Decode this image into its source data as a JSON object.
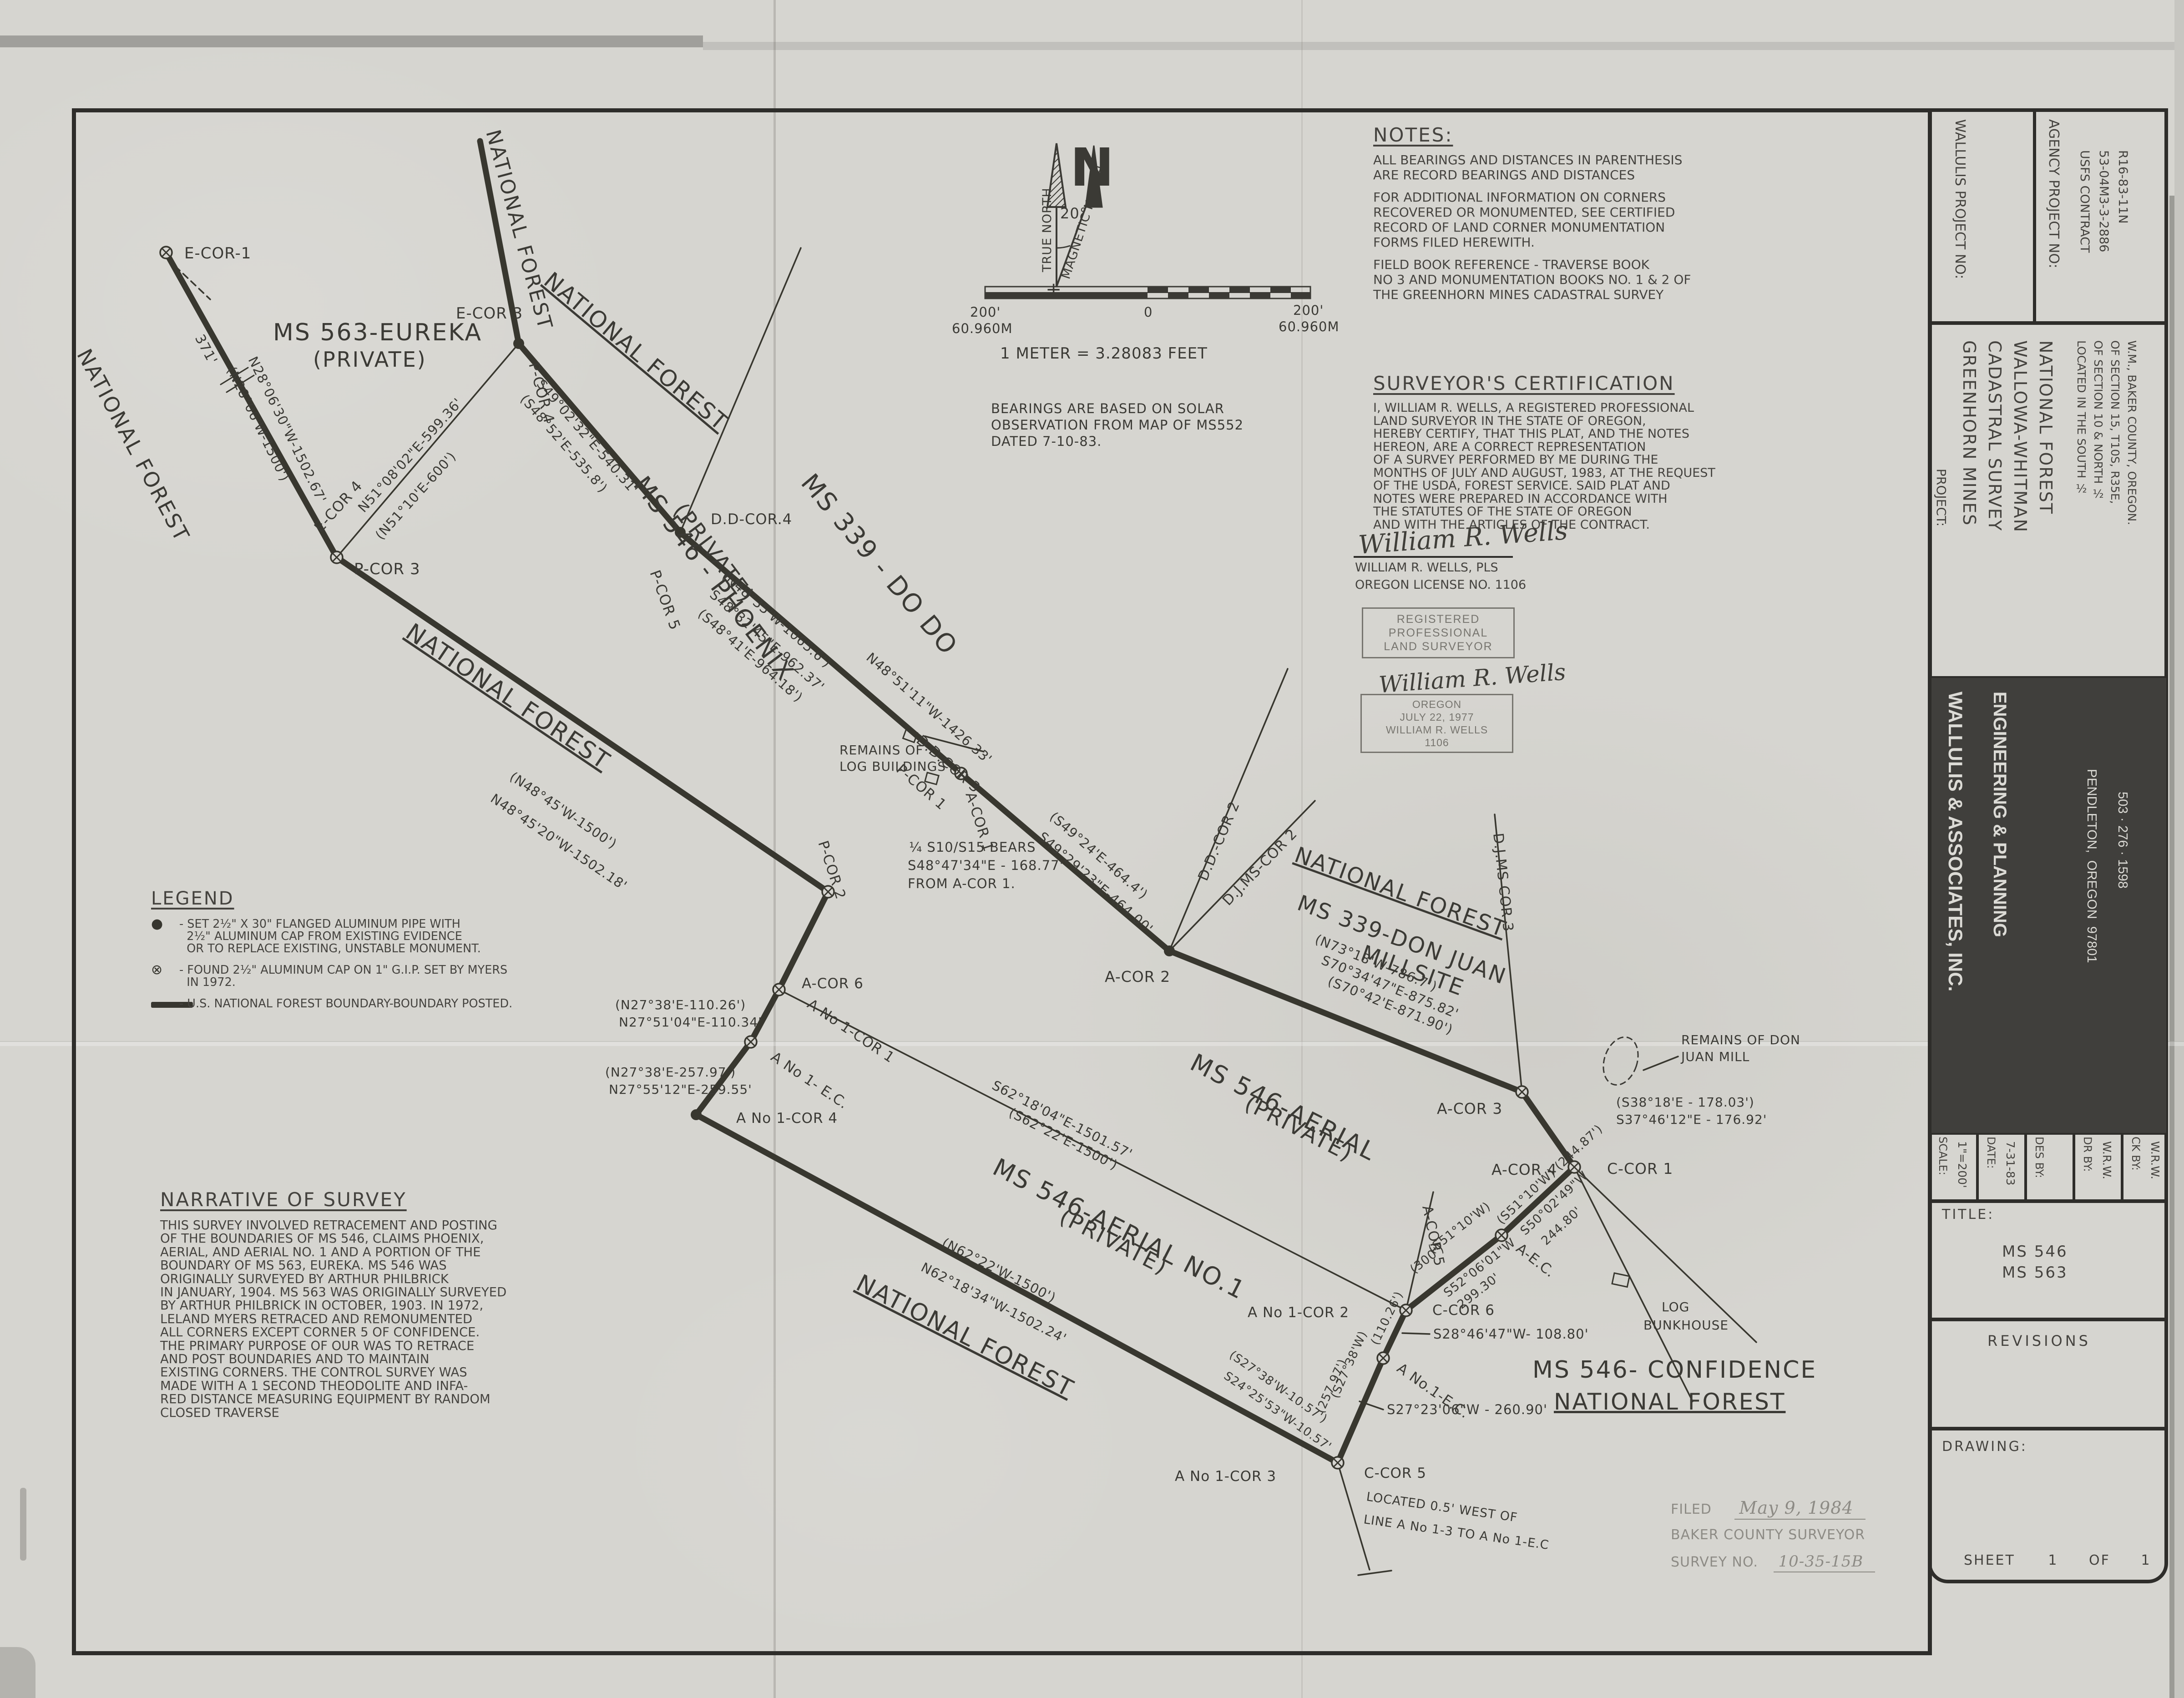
{
  "notes": {
    "title": "NOTES:",
    "p1": [
      "ALL BEARINGS AND DISTANCES IN PARENTHESIS",
      "ARE RECORD BEARINGS AND DISTANCES"
    ],
    "p2": [
      "FOR ADDITIONAL INFORMATION ON CORNERS",
      "RECOVERED OR MONUMENTED, SEE CERTIFIED",
      "RECORD OF LAND CORNER MONUMENTATION",
      "FORMS FILED HEREWITH."
    ],
    "p3": [
      "FIELD BOOK REFERENCE - TRAVERSE BOOK",
      "NO 3 AND MONUMENTATION BOOKS NO. 1 & 2 OF",
      "THE GREENHORN MINES CADASTRAL SURVEY"
    ]
  },
  "certification": {
    "title": "SURVEYOR'S CERTIFICATION",
    "body": [
      "I, WILLIAM R. WELLS, A REGISTERED PROFESSIONAL",
      "LAND SURVEYOR IN THE STATE OF OREGON,",
      "HEREBY CERTIFY, THAT THIS PLAT, AND THE NOTES",
      "HEREON, ARE A CORRECT REPRESENTATION",
      "OF A SURVEY PERFORMED BY ME DURING THE",
      "MONTHS OF JULY AND AUGUST, 1983, AT THE REQUEST",
      "OF THE USDA, FOREST SERVICE. SAID PLAT AND",
      "NOTES WERE PREPARED IN ACCORDANCE WITH",
      "THE STATUTES OF THE STATE OF OREGON",
      "AND WITH THE ARTICLES OF THE CONTRACT."
    ],
    "signature": "William R. Wells",
    "name": "WILLIAM R. WELLS, PLS",
    "license": "OREGON LICENSE  NO. 1106",
    "stamp_registered": [
      "REGISTERED",
      "PROFESSIONAL",
      "LAND SURVEYOR"
    ],
    "signature2": "William R. Wells",
    "stamp_oregon": [
      "OREGON",
      "JULY 22, 1977",
      "WILLIAM R. WELLS",
      "1106"
    ]
  },
  "legend": {
    "title": "LEGEND",
    "item1": [
      "- SET 2½\" X 30\" FLANGED ALUMINUM PIPE WITH",
      "  2½\" ALUMINUM CAP FROM EXISTING EVIDENCE",
      "  OR TO REPLACE EXISTING, UNSTABLE MONUMENT."
    ],
    "item2": [
      "- FOUND 2½\" ALUMINUM CAP ON 1\" G.I.P. SET BY MYERS",
      "  IN 1972."
    ],
    "item3": [
      "- U.S. NATIONAL FOREST BOUNDARY-BOUNDARY POSTED."
    ]
  },
  "narrative": {
    "title": "NARRATIVE OF SURVEY",
    "body": [
      "THIS SURVEY INVOLVED RETRACEMENT AND POSTING",
      "OF THE BOUNDARIES OF MS 546, CLAIMS PHOENIX,",
      "AERIAL, AND AERIAL NO. 1 AND A PORTION OF THE",
      "BOUNDARY OF MS 563, EUREKA. MS 546 WAS",
      "ORIGINALLY SURVEYED BY ARTHUR PHILBRICK",
      "IN JANUARY, 1904. MS 563 WAS ORIGINALLY SURVEYED",
      "BY ARTHUR PHILBRICK IN OCTOBER, 1903. IN 1972,",
      "LELAND MYERS RETRACED AND REMONUMENTED",
      "ALL CORNERS EXCEPT CORNER 5 OF CONFIDENCE.",
      "THE PRIMARY PURPOSE OF OUR WAS TO RETRACE",
      "AND POST BOUNDARIES AND TO MAINTAIN",
      "EXISTING CORNERS. THE CONTROL SURVEY WAS",
      "MADE WITH A 1 SECOND THEODOLITE AND INFA-",
      "RED DISTANCE MEASURING EQUIPMENT BY RANDOM",
      "CLOSED TRAVERSE"
    ]
  },
  "filed": {
    "label": "FILED",
    "date": "May 9, 1984",
    "line2": "BAKER COUNTY SURVEYOR",
    "no_label": "SURVEY NO.",
    "no_value": "10-35-15B"
  },
  "titleblock": {
    "wallulis_label": "WALLULIS PROJECT NO:",
    "agency_label": "AGENCY PROJECT NO:",
    "agency_value": [
      "USFS CONTRACT",
      "53-04M3-3-2886",
      "R16-83-11N"
    ],
    "project_label": "PROJECT:",
    "project_name": [
      "GREENHORN MINES",
      "CADASTRAL SURVEY",
      "WALLOWA-WHITMAN",
      "NATIONAL FOREST"
    ],
    "project_location": [
      "LOCATED IN THE SOUTH ½",
      "OF SECTION 10 & NORTH ½",
      "OF SECTION 15, T10S, R35E,",
      "W.M., BAKER COUNTY, OREGON."
    ],
    "firm_name": "WALLULIS & ASSOCIATES, INC.",
    "firm_dept": "ENGINEERING & PLANNING",
    "firm_city": "PENDLETON,  OREGON  97801",
    "firm_phone": "503 · 276 · 1598",
    "scale_label": "SCALE:",
    "scale_value": "1\"=200'",
    "date_label": "DATE:",
    "date_value": "7-31-83",
    "desby_label": "DES BY:",
    "desby_value": "",
    "drby_label": "DR BY:",
    "drby_value": "W.R.W.",
    "ckby_label": "CK BY:",
    "ckby_value": "W.R.W.",
    "title_label": "TITLE:",
    "title_value": [
      "MS 546",
      "MS 563"
    ],
    "revisions_label": "REVISIONS",
    "drawing_label": "DRAWING:",
    "sheet_word": "SHEET",
    "sheet_no": "1",
    "of_word": "OF",
    "of_no": "1"
  },
  "map": {
    "thick": [
      [
        365,
        555,
        740,
        1225
      ],
      [
        740,
        1225,
        1820,
        1960
      ],
      [
        1820,
        1960,
        1712,
        2175
      ],
      [
        1712,
        2175,
        1650,
        2290
      ],
      [
        1650,
        2290,
        1530,
        2450
      ],
      [
        1530,
        2450,
        2940,
        3215
      ],
      [
        3040,
        2985,
        2940,
        3215
      ],
      [
        3090,
        2880,
        3040,
        2985
      ],
      [
        3300,
        2715,
        3090,
        2880
      ],
      [
        3460,
        2565,
        3300,
        2715
      ],
      [
        3345,
        2400,
        3460,
        2565
      ],
      [
        2570,
        2090,
        3345,
        2400
      ],
      [
        2112,
        1700,
        2570,
        2090
      ],
      [
        1495,
        1170,
        2112,
        1700
      ],
      [
        1140,
        755,
        1495,
        1170
      ],
      [
        1055,
        310,
        1140,
        755
      ]
    ],
    "thin": [
      [
        740,
        1225,
        1140,
        755
      ],
      [
        1495,
        1170,
        1760,
        545
      ],
      [
        2570,
        2090,
        2830,
        1470
      ],
      [
        2570,
        2090,
        2890,
        1760
      ],
      [
        3345,
        2400,
        3285,
        1790
      ],
      [
        3460,
        2565,
        3860,
        2950
      ],
      [
        3460,
        2565,
        3720,
        3080
      ],
      [
        2940,
        3215,
        3010,
        3450
      ],
      [
        2985,
        3462,
        3058,
        3452
      ],
      [
        3090,
        2880,
        3150,
        2620
      ],
      [
        1712,
        2175,
        3090,
        2880
      ],
      [
        2162,
        1652,
        2032,
        1618
      ],
      [
        3688,
        2322,
        3612,
        2352
      ],
      [
        3142,
        2932,
        3082,
        2930
      ],
      [
        3040,
        3098,
        2988,
        3080
      ]
    ],
    "dashed": [
      [
        385,
        585,
        462,
        658
      ],
      [
        2112,
        1700,
        2200,
        1772
      ]
    ],
    "ticks": [
      [
        485,
        845,
        545,
        808
      ],
      [
        498,
        862,
        558,
        825
      ]
    ],
    "circled": [
      [
        365,
        555
      ],
      [
        740,
        1225
      ],
      [
        2112,
        1700
      ],
      [
        3345,
        2400
      ],
      [
        3460,
        2565
      ],
      [
        3300,
        2715
      ],
      [
        3090,
        2880
      ],
      [
        3040,
        2985
      ],
      [
        2940,
        3215
      ],
      [
        1650,
        2290
      ],
      [
        1712,
        2175
      ],
      [
        1820,
        1960
      ]
    ],
    "dots": [
      [
        1140,
        755
      ],
      [
        1495,
        1170
      ],
      [
        2570,
        2090
      ],
      [
        1530,
        2450
      ]
    ],
    "buildings": [
      [
        1992,
        1602,
        26,
        22,
        20
      ],
      [
        2038,
        1698,
        26,
        20,
        15
      ],
      [
        3548,
        2798,
        34,
        24,
        12
      ]
    ],
    "labels": [
      [
        "E-COR-1",
        405,
        568,
        0,
        34,
        ""
      ],
      [
        "371'",
        428,
        742,
        62,
        30,
        ""
      ],
      [
        "MS 563-EUREKA",
        600,
        748,
        0,
        52,
        ""
      ],
      [
        "(PRIVATE)",
        688,
        806,
        0,
        46,
        ""
      ],
      [
        "NATIONAL FOREST",
        1068,
        290,
        75,
        44,
        ""
      ],
      [
        "NATIONAL FOREST",
        168,
        778,
        62,
        46,
        ""
      ],
      [
        "NATIONAL FOREST",
        888,
        1398,
        34,
        52,
        "u"
      ],
      [
        "NATIONAL FOREST",
        1192,
        622,
        40,
        50,
        "u"
      ],
      [
        "MS 339 - DO DO",
        1758,
        1062,
        50,
        56,
        ""
      ],
      [
        "NATIONAL FOREST",
        2842,
        1892,
        20,
        48,
        "u"
      ],
      [
        "MS 339-DON JUAN",
        2848,
        1998,
        20,
        48,
        ""
      ],
      [
        "MILLSITE",
        2988,
        2108,
        20,
        48,
        ""
      ],
      [
        "NATIONAL FOREST",
        1878,
        2832,
        27,
        52,
        "u"
      ],
      [
        "MS 546- CONFIDENCE",
        3368,
        3028,
        0,
        52,
        ""
      ],
      [
        "NATIONAL FOREST",
        3415,
        3098,
        0,
        50,
        "u"
      ],
      [
        "MS 546 - PHOENIX",
        1390,
        1065,
        53,
        54,
        ""
      ],
      [
        "(PRIVATE)",
        1478,
        1122,
        53,
        48,
        ""
      ],
      [
        "MS 546-AERIAL",
        2612,
        2348,
        27,
        54,
        ""
      ],
      [
        "(PRIVATE)",
        2732,
        2436,
        27,
        48,
        ""
      ],
      [
        "MS 546-AERIAL NO.1",
        2178,
        2578,
        27,
        54,
        ""
      ],
      [
        "(PRIVATE)",
        2325,
        2685,
        27,
        48,
        ""
      ],
      [
        "(N28°06'W-1500')",
        498,
        812,
        64,
        29,
        ""
      ],
      [
        "N28°06'30\"W-1502.67'",
        545,
        790,
        64,
        29,
        ""
      ],
      [
        "E-COR 4",
        705,
        1172,
        -48,
        32,
        ""
      ],
      [
        "N51°08'02\"E-599.36'",
        800,
        1128,
        -48,
        29,
        ""
      ],
      [
        "(N51°10'E-600')",
        838,
        1188,
        -48,
        29,
        ""
      ],
      [
        "E-COR 3",
        1002,
        700,
        0,
        34,
        ""
      ],
      [
        "P-COR 4",
        1162,
        800,
        75,
        32,
        ""
      ],
      [
        "P-COR 3",
        778,
        1262,
        0,
        34,
        ""
      ],
      [
        "S49°02'32\"E-540.31'",
        1178,
        845,
        49,
        29,
        ""
      ],
      [
        "(S48°52'E-535.8')",
        1142,
        878,
        49,
        29,
        ""
      ],
      [
        "P-COR 5",
        1428,
        1258,
        70,
        32,
        ""
      ],
      [
        "D.D-COR.4",
        1562,
        1152,
        0,
        32,
        ""
      ],
      [
        "(N48°35'W-1065.6')",
        1585,
        1268,
        41,
        29,
        ""
      ],
      [
        "S48°32'45\"E-962.37'",
        1558,
        1310,
        41,
        29,
        ""
      ],
      [
        "(S48°41'E-964.18')",
        1532,
        1352,
        41,
        29,
        ""
      ],
      [
        "N48°51'11\"W-1426.33'",
        1902,
        1448,
        41,
        29,
        ""
      ],
      [
        "REMAINS OF",
        1845,
        1658,
        0,
        28,
        ""
      ],
      [
        "LOG BUILDINGS",
        1845,
        1694,
        0,
        28,
        ""
      ],
      [
        "D.D.COR 3",
        2012,
        1630,
        41,
        31,
        ""
      ],
      [
        "P-COR 1",
        1968,
        1694,
        41,
        31,
        ""
      ],
      [
        "A-COR 1",
        2122,
        1745,
        72,
        31,
        ""
      ],
      [
        "(S49°24'E-464.4')",
        2305,
        1798,
        41,
        29,
        ""
      ],
      [
        "S49°29'23\"E-464.00'",
        2280,
        1842,
        41,
        29,
        ""
      ],
      [
        "¼ S10/S15 BEARS",
        1998,
        1872,
        0,
        29,
        ""
      ],
      [
        "S48°47'34\"E - 168.77'",
        1995,
        1912,
        0,
        29,
        ""
      ],
      [
        "FROM A-COR 1.",
        1995,
        1952,
        0,
        29,
        ""
      ],
      [
        "A-COR 2",
        2428,
        2158,
        0,
        33,
        ""
      ],
      [
        "D.D.-COR 2",
        2652,
        1938,
        -67,
        31,
        ""
      ],
      [
        "D.J.MS-COR 2",
        2700,
        1992,
        -46,
        31,
        ""
      ],
      [
        "(N73°18'W-786.7')",
        2888,
        2072,
        22,
        29,
        ""
      ],
      [
        "S70°34'47\"E-875.82'",
        2902,
        2118,
        22,
        29,
        ""
      ],
      [
        "(S70°42'E-871.90')",
        2916,
        2164,
        22,
        29,
        ""
      ],
      [
        "D.J.MS COR 3",
        3282,
        1832,
        84,
        31,
        ""
      ],
      [
        "A-COR 3",
        3158,
        2448,
        0,
        33,
        ""
      ],
      [
        "REMAINS OF DON",
        3695,
        2295,
        0,
        28,
        ""
      ],
      [
        "JUAN MILL",
        3695,
        2332,
        0,
        28,
        ""
      ],
      [
        "(S38°18'E - 178.03')",
        3552,
        2432,
        0,
        28,
        ""
      ],
      [
        "S37°46'12\"E - 176.92'",
        3552,
        2470,
        0,
        28,
        ""
      ],
      [
        "A-COR 4",
        3278,
        2582,
        0,
        33,
        ""
      ],
      [
        "C-COR 1",
        3532,
        2580,
        0,
        33,
        ""
      ],
      [
        "(S51°10'W) (244.87')",
        3300,
        2692,
        -43,
        27,
        ""
      ],
      [
        "S50°02'49\"W",
        3352,
        2716,
        -43,
        27,
        ""
      ],
      [
        "244.80'",
        3398,
        2738,
        -43,
        27,
        ""
      ],
      [
        "A-E.C.",
        3330,
        2748,
        38,
        31,
        ""
      ],
      [
        "LOG",
        3652,
        2882,
        0,
        28,
        ""
      ],
      [
        "BUNKHOUSE",
        3612,
        2922,
        0,
        28,
        ""
      ],
      [
        "(S51°10'W)",
        3148,
        2756,
        -38,
        27,
        ""
      ],
      [
        "(300')",
        3108,
        2800,
        -38,
        27,
        ""
      ],
      [
        "S52°06'01\"W",
        3182,
        2852,
        -38,
        27,
        ""
      ],
      [
        "299.30'",
        3212,
        2878,
        -38,
        27,
        ""
      ],
      [
        "A-COR 5",
        3126,
        2652,
        78,
        31,
        ""
      ],
      [
        "A No 1-COR 2",
        2742,
        2895,
        0,
        31,
        ""
      ],
      [
        "C-COR 6",
        3148,
        2890,
        0,
        31,
        ""
      ],
      [
        "(110.26')",
        3028,
        2958,
        -64,
        26,
        ""
      ],
      [
        "S28°46'47\"W- 108.80'",
        3150,
        2942,
        0,
        29,
        ""
      ],
      [
        "A No.1-E.C.",
        3068,
        3012,
        35,
        31,
        ""
      ],
      [
        "(S27°38'W)",
        2940,
        3075,
        -66,
        26,
        ""
      ],
      [
        "(257.97')",
        2908,
        3108,
        -66,
        26,
        ""
      ],
      [
        "S27°23'06\"W - 260.90'",
        3048,
        3108,
        0,
        29,
        ""
      ],
      [
        "(S27°38'W-10.57')",
        2700,
        2982,
        35,
        26,
        ""
      ],
      [
        "S24°25'53\"W-10.57'",
        2688,
        3028,
        35,
        26,
        ""
      ],
      [
        "A No 1-COR 3",
        2582,
        3255,
        0,
        31,
        ""
      ],
      [
        "C-COR 5",
        2998,
        3248,
        0,
        31,
        ""
      ],
      [
        "LOCATED 0.5' WEST OF",
        3002,
        3298,
        8,
        27,
        ""
      ],
      [
        "LINE A No 1-3 TO A No 1-E.C",
        2996,
        3348,
        8,
        27,
        ""
      ],
      [
        "S62°18'04\"E-1501.57'",
        2178,
        2392,
        27,
        29,
        ""
      ],
      [
        "(S62°22'E-1500')",
        2215,
        2452,
        27,
        29,
        ""
      ],
      [
        "(N62°22'W-1500')",
        2068,
        2738,
        27,
        29,
        ""
      ],
      [
        "N62°18'34\"W-1502.24'",
        2022,
        2792,
        27,
        29,
        ""
      ],
      [
        "P-COR 2",
        1798,
        1852,
        72,
        31,
        ""
      ],
      [
        "A-COR 6",
        1762,
        2172,
        0,
        31,
        ""
      ],
      [
        "A No 1-COR 1",
        1772,
        2212,
        34,
        31,
        ""
      ],
      [
        "A No 1- E.C.",
        1692,
        2328,
        34,
        31,
        ""
      ],
      [
        "A No 1-COR 4",
        1618,
        2468,
        0,
        31,
        ""
      ],
      [
        "(N27°38'E-110.26')",
        1352,
        2218,
        0,
        28,
        ""
      ],
      [
        "N27°51'04\"E-110.34'",
        1360,
        2256,
        0,
        28,
        ""
      ],
      [
        "(N27°38'E-257.97')",
        1330,
        2366,
        0,
        28,
        ""
      ],
      [
        "N27°55'12\"E-259.55'",
        1338,
        2404,
        0,
        28,
        ""
      ],
      [
        "(N48°45'W-1500')",
        1118,
        1712,
        34,
        29,
        ""
      ],
      [
        "N48°45'20\"W-1502.18'",
        1076,
        1760,
        34,
        29,
        ""
      ],
      [
        "N",
        2352,
        408,
        0,
        115,
        "b"
      ],
      [
        "TRUE NORTH",
        2310,
        598,
        -90,
        27,
        ""
      ],
      [
        "MAGNETIC NORTH",
        2350,
        615,
        -72,
        27,
        ""
      ],
      [
        "20°",
        2330,
        480,
        0,
        32,
        ""
      ],
      [
        "+",
        2298,
        650,
        0,
        42,
        ""
      ],
      [
        "200'",
        2132,
        696,
        0,
        29,
        ""
      ],
      [
        "60.960M",
        2092,
        732,
        0,
        29,
        ""
      ],
      [
        "0",
        2514,
        696,
        0,
        29,
        ""
      ],
      [
        "200'",
        2842,
        692,
        0,
        29,
        ""
      ],
      [
        "60.960M",
        2810,
        728,
        0,
        29,
        ""
      ],
      [
        "1 METER = 3.28083 FEET",
        2198,
        788,
        0,
        34,
        ""
      ],
      [
        "BEARINGS ARE BASED ON SOLAR",
        2178,
        908,
        0,
        29,
        ""
      ],
      [
        "OBSERVATION FROM MAP OF MS552",
        2178,
        944,
        0,
        29,
        ""
      ],
      [
        "DATED 7-10-83.",
        2178,
        980,
        0,
        29,
        ""
      ]
    ]
  }
}
